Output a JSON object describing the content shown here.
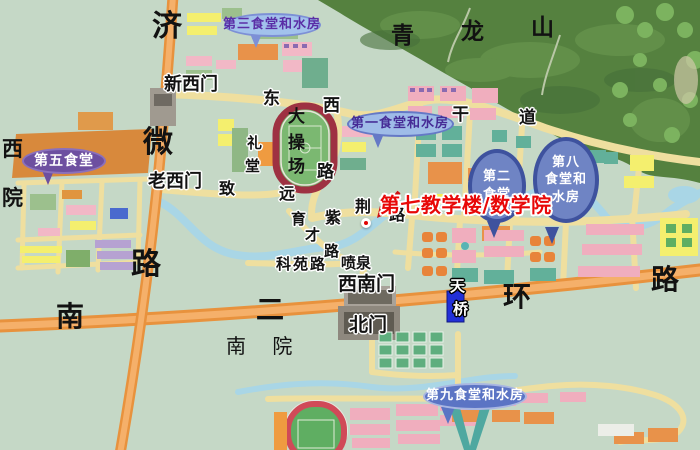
{
  "colors": {
    "ground": "#c5d8c6",
    "mountain": "#55813f",
    "water": "#a9d6e6",
    "road_primary_orange": "#e8923d",
    "road_campus_yellow": "#efdf9f",
    "callout_dark_blue": "#3e529e",
    "callout_light_blue": "#9fbce8",
    "canteen5_purple": "#6d4fa0",
    "highlight_red": "#e80808",
    "stadium_track_red": "#9e3142"
  },
  "highlight": {
    "text": "第七教学楼/数学院",
    "x": 350,
    "y": 165,
    "fs": 20,
    "color": "#e80808",
    "dot": {
      "x": 369,
      "y": 226
    },
    "arrow": {
      "x1": 399,
      "y1": 192,
      "x2": 377,
      "y2": 218
    }
  },
  "map_labels": [
    {
      "id": "road-jiwei-1",
      "t": "济",
      "x": 152,
      "y": 12,
      "s": 30,
      "b": 1
    },
    {
      "id": "road-jiwei-2",
      "t": "微",
      "x": 143,
      "y": 128,
      "s": 30,
      "b": 1
    },
    {
      "id": "road-jiwei-3",
      "t": "路",
      "x": 131,
      "y": 250,
      "s": 30,
      "b": 1
    },
    {
      "id": "road-erhuan-1",
      "t": "南",
      "x": 56,
      "y": 303,
      "s": 28,
      "b": 1
    },
    {
      "id": "road-erhuan-2",
      "t": "二",
      "x": 256,
      "y": 296,
      "s": 28,
      "b": 1
    },
    {
      "id": "road-erhuan-3",
      "t": "环",
      "x": 503,
      "y": 283,
      "s": 28,
      "b": 1
    },
    {
      "id": "road-erhuan-4",
      "t": "路",
      "x": 651,
      "y": 266,
      "s": 28,
      "b": 1
    },
    {
      "id": "mountain-qinglongshan-1",
      "t": "青",
      "x": 391,
      "y": 25,
      "s": 23,
      "b": 1
    },
    {
      "id": "mountain-qinglongshan-2",
      "t": "龙",
      "x": 461,
      "y": 21,
      "s": 23,
      "b": 1
    },
    {
      "id": "mountain-qinglongshan-3",
      "t": "山",
      "x": 531,
      "y": 17,
      "s": 23,
      "b": 1
    },
    {
      "id": "road-dongxi-1",
      "t": "东",
      "x": 263,
      "y": 91,
      "s": 17,
      "b": 1,
      "h": "light"
    },
    {
      "id": "road-dongxi-2",
      "t": "西",
      "x": 323,
      "y": 98,
      "s": 17,
      "b": 1,
      "h": "light"
    },
    {
      "id": "road-dongxi-3",
      "t": "路",
      "x": 317,
      "y": 164,
      "s": 17,
      "b": 1,
      "h": "light"
    },
    {
      "id": "road-gandao-1",
      "t": "干",
      "x": 452,
      "y": 107,
      "s": 17,
      "b": 1,
      "h": "light"
    },
    {
      "id": "road-gandao-2",
      "t": "道",
      "x": 519,
      "y": 110,
      "s": 17,
      "b": 1,
      "h": "light"
    },
    {
      "id": "road-zhiyuan-1",
      "t": "致",
      "x": 219,
      "y": 181,
      "s": 16,
      "b": 1,
      "h": "light"
    },
    {
      "id": "road-zhiyuan-2",
      "t": "远",
      "x": 279,
      "y": 186,
      "s": 16,
      "b": 1,
      "h": "light"
    },
    {
      "id": "road-zijin-1",
      "t": "紫",
      "x": 325,
      "y": 210,
      "s": 16,
      "b": 1,
      "h": "light"
    },
    {
      "id": "road-zijin-2",
      "t": "荆",
      "x": 355,
      "y": 199,
      "s": 16,
      "b": 1,
      "h": "light"
    },
    {
      "id": "road-zijin-3",
      "t": "路",
      "x": 389,
      "y": 207,
      "s": 16,
      "b": 1,
      "h": "light"
    },
    {
      "id": "road-yucai-1",
      "t": "育",
      "x": 291,
      "y": 212,
      "s": 15,
      "b": 1,
      "h": "light"
    },
    {
      "id": "road-yucai-2",
      "t": "才",
      "x": 305,
      "y": 228,
      "s": 15,
      "b": 1,
      "h": "light"
    },
    {
      "id": "road-yucai-3",
      "t": "路",
      "x": 324,
      "y": 244,
      "s": 15,
      "b": 1,
      "h": "light"
    },
    {
      "id": "road-keyuan",
      "t": "科苑路",
      "x": 276,
      "y": 257,
      "s": 15,
      "b": 1,
      "h": "light",
      "ls": 2
    },
    {
      "id": "fountain-penquan",
      "t": "喷泉",
      "x": 341,
      "y": 256,
      "s": 15,
      "b": 1,
      "h": "light"
    },
    {
      "id": "gate-xinximen",
      "t": "新西门",
      "x": 164,
      "y": 76,
      "s": 18,
      "b": 1,
      "h": "light"
    },
    {
      "id": "gate-laoximen",
      "t": "老西门",
      "x": 148,
      "y": 173,
      "s": 18,
      "b": 1,
      "h": "light"
    },
    {
      "id": "gate-xinanmen",
      "t": "西南门",
      "x": 338,
      "y": 275,
      "s": 19,
      "b": 1,
      "h": "light"
    },
    {
      "id": "gate-beimen",
      "t": "北门",
      "x": 349,
      "y": 316,
      "s": 19,
      "b": 1,
      "h": "light"
    },
    {
      "id": "bridge-tianqiao-1",
      "t": "天",
      "x": 450,
      "y": 279,
      "s": 15,
      "b": 1,
      "h": "dark",
      "c": "#ffffff"
    },
    {
      "id": "bridge-tianqiao-2",
      "t": "桥",
      "x": 453,
      "y": 302,
      "s": 15,
      "b": 1,
      "h": "dark",
      "c": "#ffffff"
    },
    {
      "id": "litang-1",
      "t": "礼",
      "x": 247,
      "y": 136,
      "s": 15,
      "b": 1,
      "h": "light"
    },
    {
      "id": "litang-2",
      "t": "堂",
      "x": 245,
      "y": 159,
      "s": 15,
      "b": 1,
      "h": "light"
    },
    {
      "id": "dacaochang-1",
      "t": "大",
      "x": 288,
      "y": 109,
      "s": 17,
      "b": 1
    },
    {
      "id": "dacaochang-2",
      "t": "操",
      "x": 288,
      "y": 135,
      "s": 17,
      "b": 1
    },
    {
      "id": "dacaochang-3",
      "t": "场",
      "x": 288,
      "y": 159,
      "s": 17,
      "b": 1
    },
    {
      "id": "xiyuan-1",
      "t": "西",
      "x": 2,
      "y": 139,
      "s": 21,
      "b": 1
    },
    {
      "id": "xiyuan-2",
      "t": "院",
      "x": 2,
      "y": 188,
      "s": 21,
      "b": 1
    },
    {
      "id": "nanyuan",
      "t": "南 院",
      "x": 226,
      "y": 336,
      "s": 20,
      "f": "serif",
      "ls": 10
    }
  ],
  "callouts": [
    {
      "id": "canteen-3",
      "shape": "ellipse",
      "cx": 272,
      "cy": 25,
      "w": 97,
      "h": 24,
      "fill": "#a2c2ec",
      "stroke": "#7d90d6",
      "tc": "#5a2ea6",
      "fs": 13,
      "lines": [
        "第三食堂和水房"
      ],
      "tail": {
        "x": 256,
        "y": 48,
        "color": "#7d90d6"
      }
    },
    {
      "id": "canteen-1",
      "shape": "ellipse",
      "cx": 400,
      "cy": 124,
      "w": 107,
      "h": 26,
      "fill": "#9fbce8",
      "stroke": "#6579c6",
      "tc": "#462c96",
      "fs": 13,
      "lines": [
        "第一食堂和水房"
      ],
      "tail": {
        "x": 378,
        "y": 148,
        "color": "#6579c6"
      }
    },
    {
      "id": "canteen-2",
      "shape": "balloon",
      "cx": 497,
      "cy": 186,
      "w": 58,
      "h": 74,
      "fill": "#3e529e",
      "inner": "#6f84c4",
      "tc": "#ffffff",
      "fs": 13,
      "lines": [
        "第二",
        "食堂"
      ],
      "tail": {
        "x": 494,
        "y": 238,
        "color": "#3e529e"
      }
    },
    {
      "id": "canteen-8",
      "shape": "balloon",
      "cx": 566,
      "cy": 180,
      "w": 66,
      "h": 86,
      "fill": "#3e529e",
      "inner": "#6f84c4",
      "tc": "#ffffff",
      "fs": 13,
      "lines": [
        "第八",
        "食堂和",
        "水房"
      ],
      "tail": {
        "x": 552,
        "y": 244,
        "color": "#3e529e"
      }
    },
    {
      "id": "canteen-9",
      "shape": "ellipse",
      "cx": 475,
      "cy": 396,
      "w": 104,
      "h": 27,
      "fill": "#5b74c4",
      "stroke": "#a8b6e2",
      "tc": "#ffffff",
      "fs": 13,
      "lines": [
        "第九食堂和水房"
      ],
      "tail": {
        "x": 448,
        "y": 424,
        "color": "#5b74c4"
      }
    },
    {
      "id": "canteen-5",
      "shape": "ellipse",
      "cx": 64,
      "cy": 161,
      "w": 84,
      "h": 26,
      "fill": "#6d4fa0",
      "stroke": "#8a70bc",
      "tc": "#ffffff",
      "fs": 14,
      "lines": [
        "第五食堂"
      ],
      "tail": {
        "x": 48,
        "y": 185,
        "color": "#6d4fa0"
      }
    }
  ]
}
